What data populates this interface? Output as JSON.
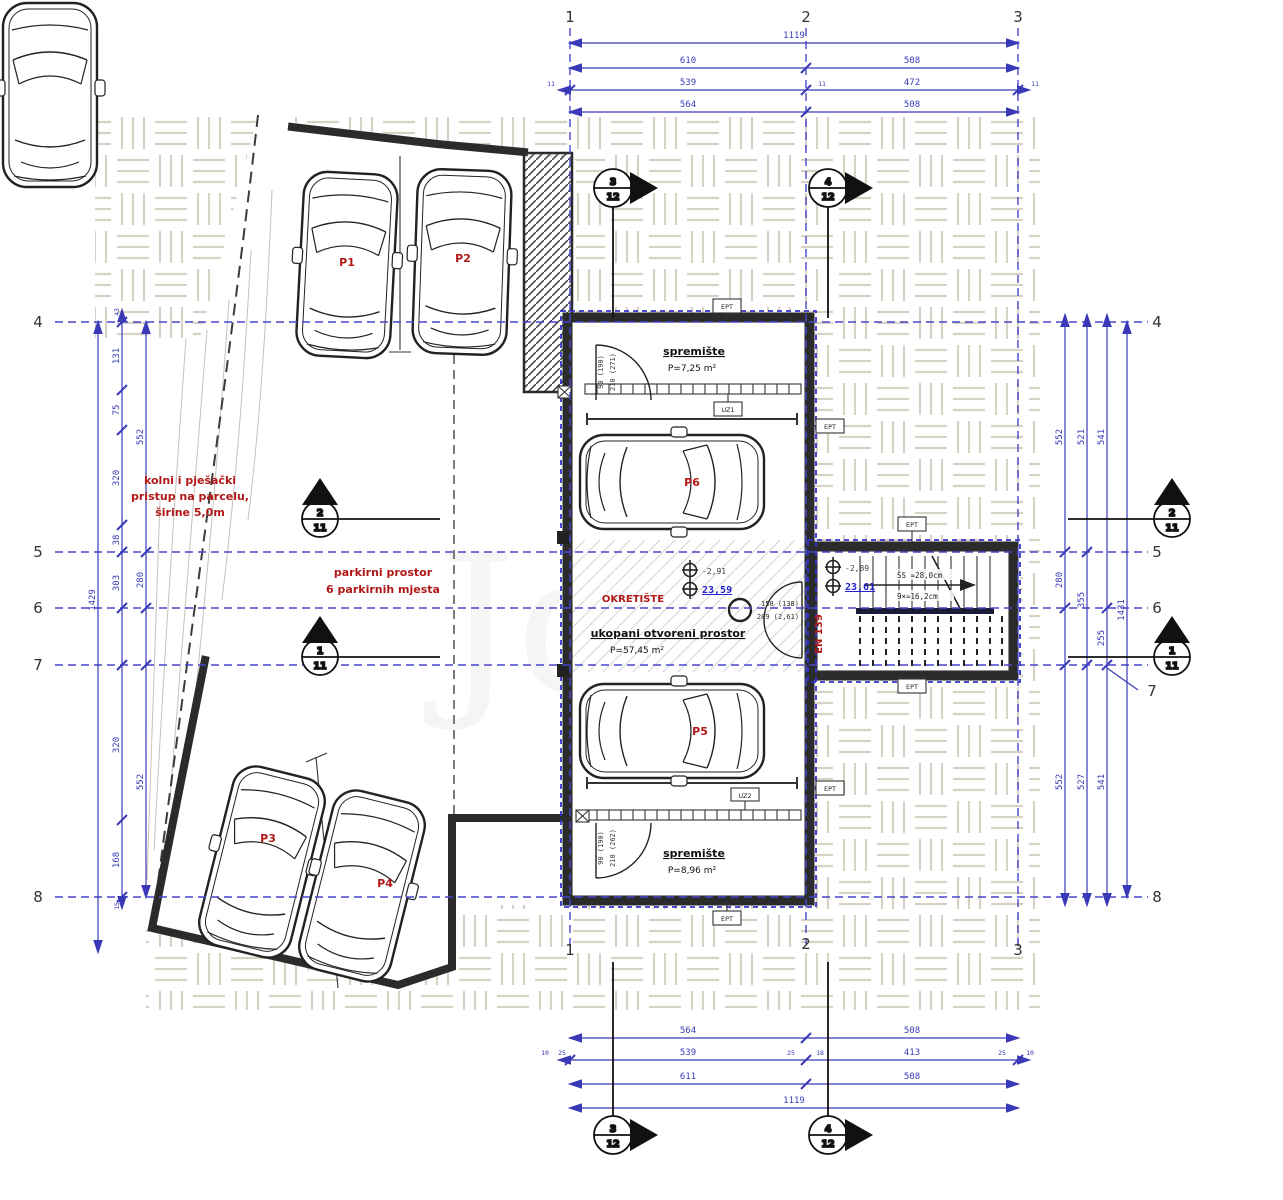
{
  "colors": {
    "dim_blue": "#3a3ab8",
    "grid_blue": "#4646cc",
    "insulation_blue": "#3333cc",
    "red": "#b01818",
    "wall_dark": "#2b2b2b",
    "value_blue": "#2222cc",
    "weave": "#d8d2c5"
  },
  "grid": {
    "v": [
      "1",
      "2",
      "3"
    ],
    "h": [
      "4",
      "5",
      "6",
      "7",
      "8"
    ]
  },
  "dims": {
    "top": {
      "overall": "1119",
      "r2": [
        "610",
        "508"
      ],
      "r3": [
        "539",
        "472"
      ],
      "r3s": [
        "11",
        "11",
        "11"
      ],
      "r4": [
        "564",
        "508"
      ]
    },
    "bottom": {
      "r1": [
        "564",
        "508"
      ],
      "r2": [
        "539",
        "413"
      ],
      "r2s": [
        "10",
        "25",
        "25",
        "18",
        "25",
        "10"
      ],
      "r3": [
        "611",
        "508"
      ],
      "overall": "1119"
    },
    "left": {
      "overall": "1429",
      "a": [
        "131",
        "75",
        "320",
        "38",
        "303",
        "320",
        "168"
      ],
      "b": [
        "552",
        "280",
        "552"
      ],
      "small_top": "43",
      "small_bottom": "15"
    },
    "right": {
      "a": [
        "552",
        "280",
        "552"
      ],
      "b": [
        "521",
        "355",
        "527"
      ],
      "c": [
        "541",
        "255",
        "541"
      ],
      "overall": "1431"
    }
  },
  "sections": {
    "s3": {
      "n": "3",
      "d": "12"
    },
    "s4": {
      "n": "4",
      "d": "12"
    },
    "s1": {
      "n": "1",
      "d": "11"
    },
    "s2": {
      "n": "2",
      "d": "11"
    }
  },
  "site": {
    "access": [
      "kolni i pješački",
      "pristup na parcelu,",
      "širine 5,0m"
    ],
    "parking": [
      "parkirni prostor",
      "6 parkirnih mjesta"
    ]
  },
  "cars": [
    "P1",
    "P2",
    "P3",
    "P4",
    "P5",
    "P6"
  ],
  "rooms": {
    "top": {
      "name": "spremište",
      "area": "P=7,25 m²"
    },
    "mid": {
      "turn": "OKRETIŠTE",
      "name": "ukopani otvoreni prostor",
      "area": "P=57,45 m²"
    },
    "bottom": {
      "name": "spremište",
      "area": "P=8,96 m²"
    }
  },
  "levels": {
    "left": {
      "rel": "-2,91",
      "abs": "23,59"
    },
    "right": {
      "rel": "-2,89",
      "abs": "23,61"
    }
  },
  "stairs": {
    "l1": "ŠS ≈28,0cm",
    "l2": "9×≈16,2cm"
  },
  "doors": {
    "center": [
      "158 (138)",
      "209 (2,61)"
    ],
    "top": [
      "90 (190)",
      "210 (271)"
    ],
    "bottom": [
      "90 (190)",
      "210 (262)"
    ]
  },
  "tags": {
    "ept": "EPT",
    "uz1": "UZ1",
    "uz2": "UZ2",
    "en": "EN 139"
  },
  "watermark": "Jd"
}
